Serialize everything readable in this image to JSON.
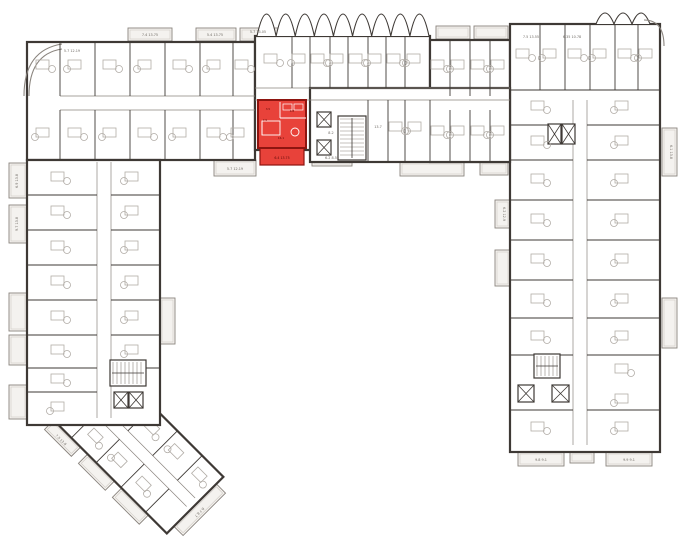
{
  "canvas": {
    "w": 680,
    "h": 551
  },
  "palette": {
    "bg": "#ffffff",
    "wall": "#3e3935",
    "wall_light": "#8a847e",
    "furn": "#b1aca6",
    "balcony_fill": "#f4f2ef",
    "red_fill": "#e8423a",
    "red_dark": "#8e1510",
    "red_text": "#5c0b08",
    "label": "#6f6a64"
  },
  "selected_unit": {
    "rect": {
      "x": 258,
      "y": 100,
      "w": 48,
      "h": 48
    },
    "balcony": {
      "x": 260,
      "y": 148,
      "w": 44,
      "h": 17
    },
    "inner_lines": [
      [
        280,
        102,
        280,
        118
      ],
      [
        280,
        118,
        306,
        118
      ],
      [
        262,
        121,
        262,
        135
      ]
    ],
    "bed": {
      "x": 262,
      "y": 121,
      "w": 18,
      "h": 14
    },
    "table": {
      "cx": 295,
      "cy": 132,
      "r": 4
    },
    "fixtures": [
      [
        283,
        104,
        9,
        6
      ],
      [
        294,
        104,
        9,
        6
      ]
    ],
    "room_labels": [
      {
        "t": "3.5",
        "x": 268,
        "y": 110
      },
      {
        "t": "4.8",
        "x": 292,
        "y": 112
      },
      {
        "t": "7.5",
        "x": 265,
        "y": 121
      },
      {
        "t": "16.1",
        "x": 281,
        "y": 139
      }
    ],
    "balcony_label": {
      "t": "6.4 13.75",
      "x": 282,
      "y": 159
    }
  },
  "blocks": [
    {
      "x": 27,
      "y": 42,
      "w": 228,
      "h": 118
    },
    {
      "x": 255,
      "y": 36,
      "w": 175,
      "h": 114
    },
    {
      "x": 430,
      "y": 40,
      "w": 80,
      "h": 122
    },
    {
      "x": 510,
      "y": 24,
      "w": 150,
      "h": 428
    },
    {
      "x": 310,
      "y": 88,
      "w": 200,
      "h": 74
    },
    {
      "x": 27,
      "y": 160,
      "w": 133,
      "h": 265
    }
  ],
  "corridors": [
    [
      60,
      96,
      255,
      96
    ],
    [
      60,
      110,
      255,
      110
    ],
    [
      255,
      88,
      510,
      88
    ],
    [
      255,
      100,
      510,
      100
    ],
    [
      97,
      162,
      97,
      418
    ],
    [
      111,
      162,
      111,
      418
    ],
    [
      573,
      100,
      573,
      445
    ],
    [
      587,
      100,
      587,
      445
    ]
  ],
  "dividers": [
    [
      60,
      42,
      60,
      96
    ],
    [
      95,
      42,
      95,
      96
    ],
    [
      130,
      42,
      130,
      96
    ],
    [
      165,
      42,
      165,
      96
    ],
    [
      200,
      42,
      200,
      96
    ],
    [
      233,
      42,
      233,
      96
    ],
    [
      60,
      110,
      60,
      160
    ],
    [
      95,
      110,
      95,
      160
    ],
    [
      130,
      110,
      130,
      160
    ],
    [
      165,
      110,
      165,
      160
    ],
    [
      200,
      110,
      200,
      160
    ],
    [
      233,
      110,
      233,
      160
    ],
    [
      292,
      36,
      292,
      88
    ],
    [
      310,
      36,
      310,
      88
    ],
    [
      330,
      36,
      330,
      88
    ],
    [
      348,
      36,
      348,
      88
    ],
    [
      368,
      36,
      368,
      88
    ],
    [
      386,
      36,
      386,
      88
    ],
    [
      405,
      36,
      405,
      88
    ],
    [
      368,
      100,
      368,
      162
    ],
    [
      388,
      100,
      388,
      162
    ],
    [
      405,
      100,
      405,
      162
    ],
    [
      430,
      100,
      430,
      162
    ],
    [
      450,
      110,
      450,
      162
    ],
    [
      470,
      110,
      470,
      162
    ],
    [
      490,
      110,
      490,
      162
    ],
    [
      450,
      40,
      450,
      96
    ],
    [
      470,
      40,
      470,
      96
    ],
    [
      490,
      40,
      490,
      96
    ],
    [
      540,
      24,
      540,
      90
    ],
    [
      565,
      24,
      565,
      90
    ],
    [
      590,
      24,
      590,
      90
    ],
    [
      615,
      24,
      615,
      90
    ],
    [
      638,
      24,
      638,
      90
    ],
    [
      510,
      90,
      660,
      90
    ],
    [
      510,
      125,
      573,
      125
    ],
    [
      587,
      125,
      660,
      125
    ],
    [
      510,
      160,
      573,
      160
    ],
    [
      587,
      160,
      660,
      160
    ],
    [
      510,
      200,
      573,
      200
    ],
    [
      587,
      200,
      660,
      200
    ],
    [
      510,
      240,
      573,
      240
    ],
    [
      587,
      240,
      660,
      240
    ],
    [
      510,
      280,
      573,
      280
    ],
    [
      587,
      280,
      660,
      280
    ],
    [
      510,
      318,
      573,
      318
    ],
    [
      587,
      318,
      660,
      318
    ],
    [
      510,
      355,
      573,
      355
    ],
    [
      587,
      355,
      660,
      355
    ],
    [
      510,
      410,
      573,
      410
    ],
    [
      587,
      410,
      660,
      410
    ],
    [
      27,
      195,
      97,
      195
    ],
    [
      111,
      195,
      160,
      195
    ],
    [
      27,
      230,
      97,
      230
    ],
    [
      111,
      230,
      160,
      230
    ],
    [
      27,
      265,
      97,
      265
    ],
    [
      111,
      265,
      160,
      265
    ],
    [
      27,
      300,
      97,
      300
    ],
    [
      111,
      300,
      160,
      300
    ],
    [
      27,
      335,
      97,
      335
    ],
    [
      111,
      335,
      160,
      335
    ],
    [
      27,
      368,
      97,
      368
    ],
    [
      111,
      368,
      160,
      368
    ],
    [
      27,
      392,
      97,
      392
    ]
  ],
  "swags": [
    {
      "x1": 257,
      "x2": 429,
      "y": 36,
      "depth": 22,
      "n": 9
    },
    {
      "x1": 596,
      "x2": 650,
      "y": 24,
      "depth": 11,
      "n": 3
    }
  ],
  "curves": [
    "M24,96 Q24,50 62,44",
    "M29,96 Q29,54 62,49",
    "M644,20 Q664,20 664,46"
  ],
  "balconies": [
    {
      "x": 9,
      "y": 163,
      "w": 18,
      "h": 35
    },
    {
      "x": 9,
      "y": 205,
      "w": 18,
      "h": 38
    },
    {
      "x": 9,
      "y": 293,
      "w": 18,
      "h": 38
    },
    {
      "x": 9,
      "y": 335,
      "w": 18,
      "h": 30
    },
    {
      "x": 9,
      "y": 385,
      "w": 18,
      "h": 34
    },
    {
      "x": 128,
      "y": 28,
      "w": 44,
      "h": 13
    },
    {
      "x": 196,
      "y": 28,
      "w": 40,
      "h": 13
    },
    {
      "x": 240,
      "y": 28,
      "w": 40,
      "h": 13
    },
    {
      "x": 436,
      "y": 26,
      "w": 34,
      "h": 13
    },
    {
      "x": 474,
      "y": 26,
      "w": 34,
      "h": 13
    },
    {
      "x": 214,
      "y": 160,
      "w": 42,
      "h": 16
    },
    {
      "x": 312,
      "y": 150,
      "w": 40,
      "h": 16
    },
    {
      "x": 400,
      "y": 162,
      "w": 64,
      "h": 14
    },
    {
      "x": 480,
      "y": 162,
      "w": 28,
      "h": 13
    },
    {
      "x": 160,
      "y": 298,
      "w": 15,
      "h": 46
    },
    {
      "x": 495,
      "y": 200,
      "w": 15,
      "h": 28
    },
    {
      "x": 495,
      "y": 250,
      "w": 15,
      "h": 36
    },
    {
      "x": 662,
      "y": 128,
      "w": 15,
      "h": 48
    },
    {
      "x": 662,
      "y": 298,
      "w": 15,
      "h": 50
    },
    {
      "x": 518,
      "y": 452,
      "w": 46,
      "h": 14
    },
    {
      "x": 570,
      "y": 452,
      "w": 24,
      "h": 11
    },
    {
      "x": 606,
      "y": 452,
      "w": 46,
      "h": 14
    }
  ],
  "cores": {
    "elevators": [
      {
        "x": 317,
        "y": 112,
        "w": 14,
        "h": 15
      },
      {
        "x": 317,
        "y": 140,
        "w": 14,
        "h": 15
      },
      {
        "x": 114,
        "y": 392,
        "w": 14,
        "h": 16
      },
      {
        "x": 129,
        "y": 392,
        "w": 14,
        "h": 16
      },
      {
        "x": 548,
        "y": 124,
        "w": 13,
        "h": 20
      },
      {
        "x": 562,
        "y": 124,
        "w": 13,
        "h": 20
      },
      {
        "x": 518,
        "y": 385,
        "w": 16,
        "h": 17
      },
      {
        "x": 552,
        "y": 385,
        "w": 17,
        "h": 17
      }
    ],
    "stairs": [
      {
        "x": 338,
        "y": 116,
        "w": 28,
        "h": 44,
        "t": "h"
      },
      {
        "x": 110,
        "y": 360,
        "w": 36,
        "h": 26,
        "t": "v"
      },
      {
        "x": 534,
        "y": 354,
        "w": 26,
        "h": 24,
        "t": "v"
      }
    ]
  },
  "furniture_anchors": [
    [
      45,
      66
    ],
    [
      77,
      66
    ],
    [
      112,
      66
    ],
    [
      147,
      66
    ],
    [
      182,
      66
    ],
    [
      216,
      66
    ],
    [
      244,
      66
    ],
    [
      45,
      134
    ],
    [
      77,
      134
    ],
    [
      112,
      134
    ],
    [
      147,
      134
    ],
    [
      182,
      134
    ],
    [
      216,
      134
    ],
    [
      240,
      134
    ],
    [
      273,
      60
    ],
    [
      301,
      60
    ],
    [
      320,
      60
    ],
    [
      339,
      60
    ],
    [
      358,
      60
    ],
    [
      377,
      60
    ],
    [
      396,
      60
    ],
    [
      416,
      60
    ],
    [
      398,
      128
    ],
    [
      417,
      128
    ],
    [
      440,
      66
    ],
    [
      460,
      66
    ],
    [
      480,
      66
    ],
    [
      500,
      66
    ],
    [
      440,
      132
    ],
    [
      460,
      132
    ],
    [
      480,
      132
    ],
    [
      500,
      132
    ],
    [
      525,
      55
    ],
    [
      552,
      55
    ],
    [
      577,
      55
    ],
    [
      602,
      55
    ],
    [
      627,
      55
    ],
    [
      648,
      55
    ],
    [
      540,
      107
    ],
    [
      624,
      107
    ],
    [
      540,
      142
    ],
    [
      624,
      142
    ],
    [
      540,
      180
    ],
    [
      624,
      180
    ],
    [
      540,
      220
    ],
    [
      624,
      220
    ],
    [
      540,
      260
    ],
    [
      624,
      260
    ],
    [
      540,
      300
    ],
    [
      624,
      300
    ],
    [
      540,
      337
    ],
    [
      624,
      337
    ],
    [
      624,
      370
    ],
    [
      624,
      400
    ],
    [
      540,
      428
    ],
    [
      624,
      428
    ],
    [
      60,
      178
    ],
    [
      134,
      178
    ],
    [
      60,
      212
    ],
    [
      134,
      212
    ],
    [
      60,
      247
    ],
    [
      134,
      247
    ],
    [
      60,
      282
    ],
    [
      134,
      282
    ],
    [
      60,
      317
    ],
    [
      134,
      317
    ],
    [
      60,
      351
    ],
    [
      134,
      351
    ],
    [
      60,
      380
    ],
    [
      60,
      408
    ]
  ],
  "angled_wing": {
    "rotate": "rotate(45 135 445)",
    "rect": {
      "x": 50,
      "y": 405,
      "w": 170,
      "h": 80
    },
    "corridor": [
      [
        55,
        440,
        215,
        440
      ],
      [
        55,
        452,
        215,
        452
      ]
    ],
    "dividers": [
      [
        85,
        405,
        85,
        440
      ],
      [
        120,
        405,
        120,
        440
      ],
      [
        155,
        405,
        155,
        440
      ],
      [
        190,
        405,
        190,
        440
      ],
      [
        85,
        452,
        85,
        485
      ],
      [
        120,
        452,
        120,
        485
      ],
      [
        155,
        452,
        155,
        485
      ],
      [
        190,
        452,
        190,
        485
      ]
    ],
    "balconies": [
      {
        "x": 60,
        "y": 485,
        "w": 38,
        "h": 13
      },
      {
        "x": 108,
        "y": 485,
        "w": 38,
        "h": 13
      },
      {
        "x": 156,
        "y": 485,
        "w": 38,
        "h": 13
      },
      {
        "x": 220,
        "y": 415,
        "w": 13,
        "h": 60
      }
    ],
    "anchors": [
      [
        70,
        422
      ],
      [
        103,
        422
      ],
      [
        137,
        422
      ],
      [
        171,
        422
      ],
      [
        204,
        422
      ],
      [
        70,
        468
      ],
      [
        103,
        468
      ],
      [
        137,
        468
      ],
      [
        171,
        468
      ]
    ],
    "labels": [
      {
        "t": "7.5 13.8",
        "x": 79,
        "y": 495
      },
      {
        "t": "8.7 8.7",
        "x": 227,
        "y": 447,
        "rot": 90
      }
    ]
  },
  "labels": [
    {
      "t": "5.7 12.19",
      "x": 72,
      "y": 52
    },
    {
      "t": "7.4 13.75",
      "x": 150,
      "y": 36
    },
    {
      "t": "5.4 13.75",
      "x": 215,
      "y": 36
    },
    {
      "t": "5.7 13.05",
      "x": 258,
      "y": 33
    },
    {
      "t": "7.5 13.55",
      "x": 531,
      "y": 38
    },
    {
      "t": "6.35 10.78",
      "x": 572,
      "y": 38
    },
    {
      "t": "5.7 12.19",
      "x": 235,
      "y": 170
    },
    {
      "t": "6.2 8.55",
      "x": 332,
      "y": 159
    },
    {
      "t": "13.7",
      "x": 378,
      "y": 128
    },
    {
      "t": "8.2",
      "x": 331,
      "y": 134
    },
    {
      "t": "9.8 9.1",
      "x": 541,
      "y": 461
    },
    {
      "t": "9.9 9.1",
      "x": 629,
      "y": 461
    },
    {
      "t": "6.9 13.8",
      "x": 18,
      "y": 181,
      "rot": -90
    },
    {
      "t": "9.7 13.8",
      "x": 18,
      "y": 224,
      "rot": -90
    },
    {
      "t": "6.1 13.8",
      "x": 670,
      "y": 152,
      "rot": 90
    },
    {
      "t": "6.2 12.9",
      "x": 503,
      "y": 214,
      "rot": 90
    }
  ]
}
